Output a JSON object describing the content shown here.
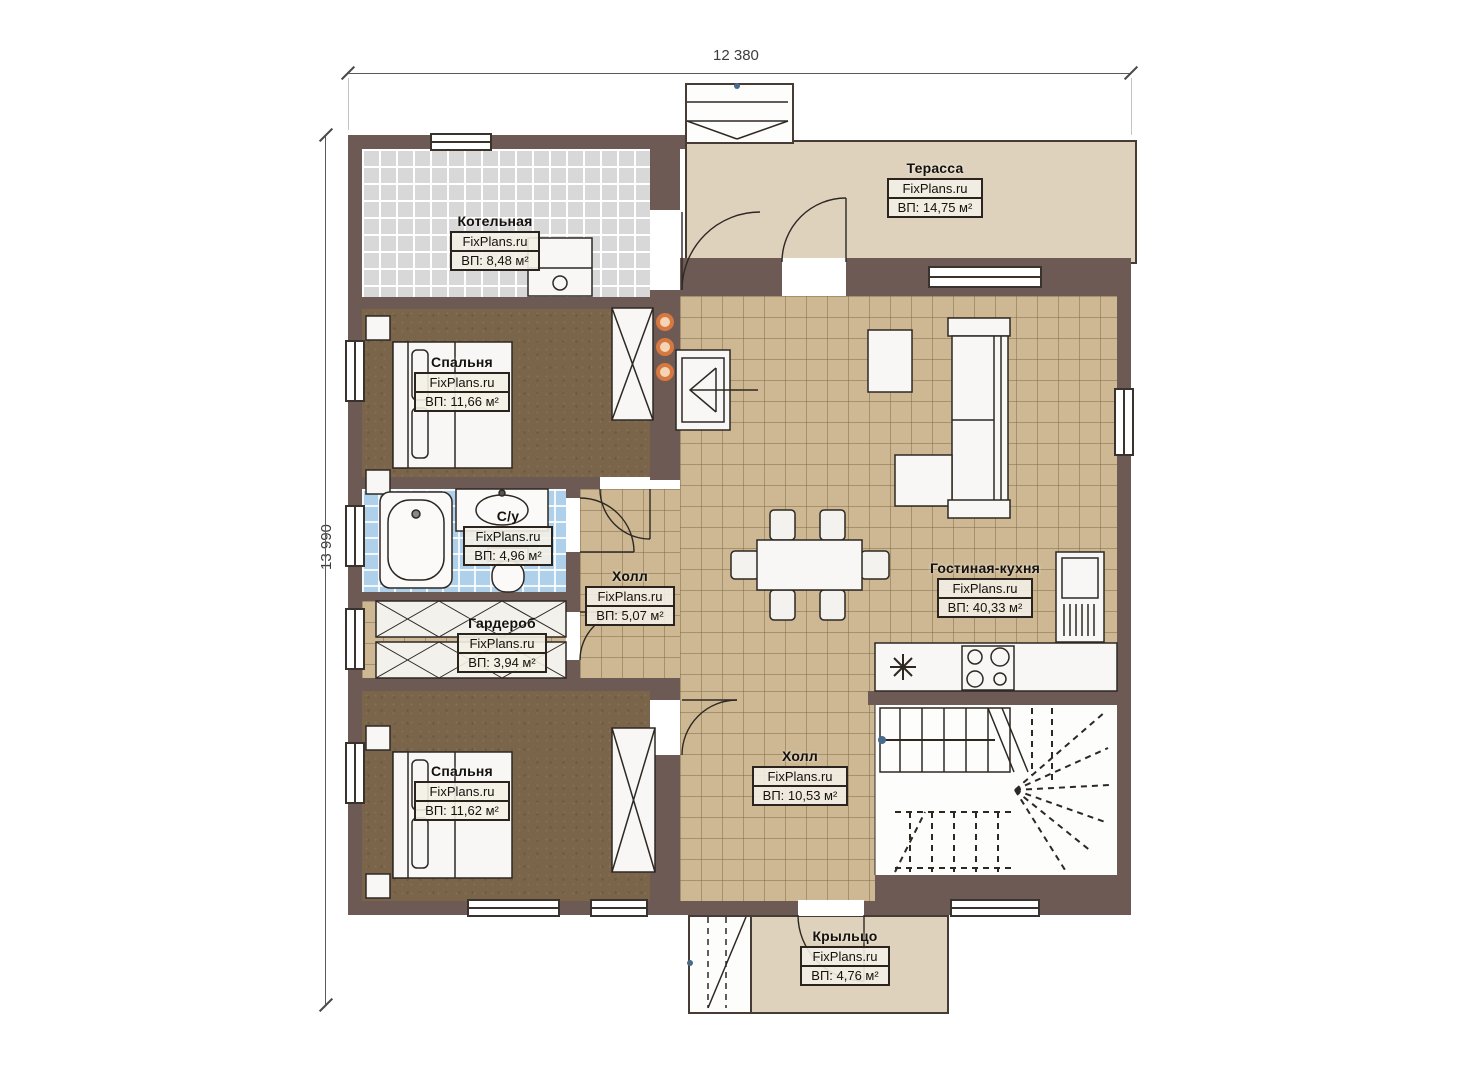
{
  "plan": {
    "type": "floor-plan",
    "brand": "FixPlans.ru"
  },
  "dimensions": {
    "width_label": "12 380",
    "height_label": "13 990"
  },
  "rooms": [
    {
      "id": "terrace",
      "name": "Терасса",
      "brand": "FixPlans.ru",
      "area": "ВП: 14,75 м²"
    },
    {
      "id": "boiler",
      "name": "Котельная",
      "brand": "FixPlans.ru",
      "area": "ВП: 8,48 м²"
    },
    {
      "id": "bedroom-1",
      "name": "Спальня",
      "brand": "FixPlans.ru",
      "area": "ВП: 11,66 м²"
    },
    {
      "id": "bathroom",
      "name": "С/у",
      "brand": "FixPlans.ru",
      "area": "ВП: 4,96 м²"
    },
    {
      "id": "hall-small",
      "name": "Холл",
      "brand": "FixPlans.ru",
      "area": "ВП: 5,07 м²"
    },
    {
      "id": "wardrobe",
      "name": "Гардероб",
      "brand": "FixPlans.ru",
      "area": "ВП: 3,94 м²"
    },
    {
      "id": "bedroom-2",
      "name": "Спальня",
      "brand": "FixPlans.ru",
      "area": "ВП: 11,62 м²"
    },
    {
      "id": "living-kitchen",
      "name": "Гостиная-кухня",
      "brand": "FixPlans.ru",
      "area": "ВП: 40,33 м²"
    },
    {
      "id": "hall-large",
      "name": "Холл",
      "brand": "FixPlans.ru",
      "area": "ВП: 10,53 м²"
    },
    {
      "id": "porch",
      "name": "Крыльцо",
      "brand": "FixPlans.ru",
      "area": "ВП: 4,76 м²"
    }
  ],
  "colors": {
    "wall": "#6e5a55",
    "floor_tile": "#cdb893",
    "carpet": "#7b654a",
    "bath_tile": "#aed0ea",
    "boiler_tile": "#d8d8d8",
    "outdoor": "#ded2bc",
    "flue_dots": "#d77840"
  }
}
